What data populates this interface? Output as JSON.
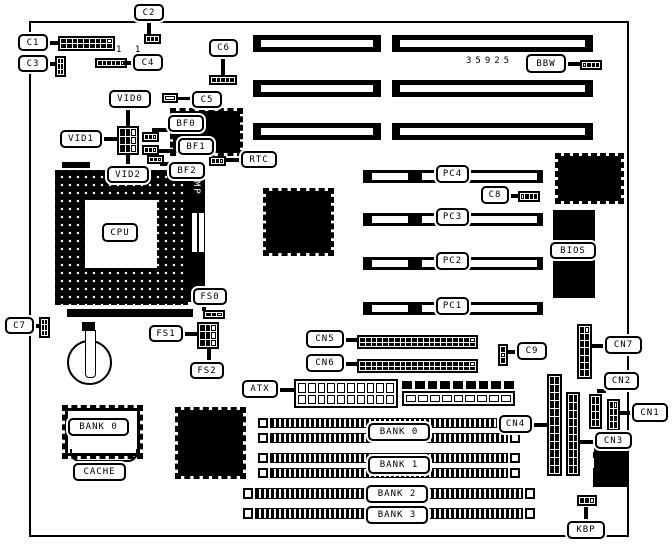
{
  "meta": {
    "description": "Motherboard jumper/connector location diagram, black and white line art",
    "bg_color": "#ffffff",
    "fg_color": "#000000",
    "part_number": "35925"
  },
  "board": {
    "x": 29,
    "y": 21,
    "w": 596,
    "h": 512
  },
  "texts": [
    {
      "id": "part-number",
      "text": "35925",
      "x": 466,
      "y": 56
    },
    {
      "id": "pin1-marks",
      "text": "1 1",
      "x": 116,
      "y": 45
    }
  ],
  "callouts": [
    {
      "id": "c1",
      "label": "C1",
      "x": 18,
      "y": 34,
      "w": 30,
      "h": 17
    },
    {
      "id": "c2",
      "label": "C2",
      "x": 134,
      "y": 4,
      "w": 30,
      "h": 17
    },
    {
      "id": "c3",
      "label": "C3",
      "x": 18,
      "y": 55,
      "w": 30,
      "h": 17
    },
    {
      "id": "c4",
      "label": "C4",
      "x": 133,
      "y": 54,
      "w": 30,
      "h": 17
    },
    {
      "id": "c5",
      "label": "C5",
      "x": 192,
      "y": 91,
      "w": 30,
      "h": 17
    },
    {
      "id": "c6",
      "label": "C6",
      "x": 209,
      "y": 39,
      "w": 29,
      "h": 18
    },
    {
      "id": "c7",
      "label": "C7",
      "x": 5,
      "y": 317,
      "w": 29,
      "h": 17
    },
    {
      "id": "c8",
      "label": "C8",
      "x": 481,
      "y": 186,
      "w": 28,
      "h": 18
    },
    {
      "id": "c9",
      "label": "C9",
      "x": 517,
      "y": 342,
      "w": 30,
      "h": 18
    },
    {
      "id": "vid0",
      "label": "VID0",
      "x": 109,
      "y": 90,
      "w": 42,
      "h": 18
    },
    {
      "id": "vid1",
      "label": "VID1",
      "x": 60,
      "y": 130,
      "w": 42,
      "h": 18
    },
    {
      "id": "vid2",
      "label": "VID2",
      "x": 107,
      "y": 166,
      "w": 42,
      "h": 17
    },
    {
      "id": "bf0",
      "label": "BF0",
      "x": 168,
      "y": 115,
      "w": 36,
      "h": 17
    },
    {
      "id": "bf1",
      "label": "BF1",
      "x": 178,
      "y": 138,
      "w": 36,
      "h": 17
    },
    {
      "id": "bf2",
      "label": "BF2",
      "x": 169,
      "y": 162,
      "w": 36,
      "h": 17
    },
    {
      "id": "rtc",
      "label": "RTC",
      "x": 241,
      "y": 151,
      "w": 36,
      "h": 17
    },
    {
      "id": "cpu",
      "label": "CPU",
      "x": 102,
      "y": 223,
      "w": 36,
      "h": 19
    },
    {
      "id": "fs0",
      "label": "FS0",
      "x": 193,
      "y": 288,
      "w": 34,
      "h": 17
    },
    {
      "id": "fs1",
      "label": "FS1",
      "x": 149,
      "y": 325,
      "w": 34,
      "h": 17
    },
    {
      "id": "fs2",
      "label": "FS2",
      "x": 190,
      "y": 362,
      "w": 34,
      "h": 17
    },
    {
      "id": "cache",
      "label": "CACHE",
      "x": 73,
      "y": 463,
      "w": 53,
      "h": 18
    },
    {
      "id": "atx",
      "label": "ATX",
      "x": 242,
      "y": 380,
      "w": 36,
      "h": 18
    },
    {
      "id": "cn5",
      "label": "CN5",
      "x": 306,
      "y": 330,
      "w": 38,
      "h": 18
    },
    {
      "id": "cn6",
      "label": "CN6",
      "x": 306,
      "y": 354,
      "w": 38,
      "h": 18
    },
    {
      "id": "bbw",
      "label": "BBW",
      "x": 526,
      "y": 54,
      "w": 40,
      "h": 19
    },
    {
      "id": "bios",
      "label": "BIOS",
      "x": 550,
      "y": 242,
      "w": 46,
      "h": 17
    },
    {
      "id": "cn7",
      "label": "CN7",
      "x": 605,
      "y": 336,
      "w": 37,
      "h": 18
    },
    {
      "id": "cn2",
      "label": "CN2",
      "x": 604,
      "y": 372,
      "w": 35,
      "h": 18
    },
    {
      "id": "cn1",
      "label": "CN1",
      "x": 632,
      "y": 403,
      "w": 36,
      "h": 19
    },
    {
      "id": "cn3",
      "label": "CN3",
      "x": 595,
      "y": 432,
      "w": 37,
      "h": 17
    },
    {
      "id": "cn4",
      "label": "CN4",
      "x": 499,
      "y": 415,
      "w": 33,
      "h": 18
    },
    {
      "id": "kbp",
      "label": "KBP",
      "x": 567,
      "y": 521,
      "w": 38,
      "h": 18
    },
    {
      "id": "pc4",
      "label": "PC4",
      "x": 436,
      "y": 165,
      "w": 33,
      "h": 18
    },
    {
      "id": "pc3",
      "label": "PC3",
      "x": 436,
      "y": 208,
      "w": 33,
      "h": 18
    },
    {
      "id": "pc2",
      "label": "PC2",
      "x": 436,
      "y": 252,
      "w": 33,
      "h": 18
    },
    {
      "id": "pc1",
      "label": "PC1",
      "x": 436,
      "y": 297,
      "w": 33,
      "h": 18
    },
    {
      "id": "bank0-cache",
      "label": "BANK 0",
      "x": 68,
      "y": 418,
      "w": 61,
      "h": 18
    },
    {
      "id": "bank0",
      "label": "BANK 0",
      "x": 368,
      "y": 423,
      "w": 62,
      "h": 18
    },
    {
      "id": "bank1",
      "label": "BANK 1",
      "x": 368,
      "y": 456,
      "w": 62,
      "h": 18
    },
    {
      "id": "bank2",
      "label": "BANK 2",
      "x": 366,
      "y": 485,
      "w": 62,
      "h": 18
    },
    {
      "id": "bank3",
      "label": "BANK 3",
      "x": 366,
      "y": 506,
      "w": 62,
      "h": 18
    }
  ],
  "stems": [
    {
      "id": "c1-stem",
      "x": 48,
      "y": 41,
      "w": 11,
      "h": 4
    },
    {
      "id": "c2-stem",
      "x": 147,
      "y": 21,
      "w": 4,
      "h": 14
    },
    {
      "id": "c3-stem",
      "x": 48,
      "y": 62,
      "w": 9,
      "h": 4
    },
    {
      "id": "c4-stem",
      "x": 124,
      "y": 61,
      "w": 9,
      "h": 4
    },
    {
      "id": "c5-stem",
      "x": 177,
      "y": 97,
      "w": 15,
      "h": 3
    },
    {
      "id": "c6-stem",
      "x": 221,
      "y": 57,
      "w": 4,
      "h": 19
    },
    {
      "id": "c7-stem",
      "x": 34,
      "y": 324,
      "w": 6,
      "h": 4
    },
    {
      "id": "c8-stem",
      "x": 509,
      "y": 194,
      "w": 11,
      "h": 4
    },
    {
      "id": "c9-stem",
      "x": 507,
      "y": 350,
      "w": 10,
      "h": 4
    },
    {
      "id": "vid0-stem",
      "x": 126,
      "y": 108,
      "w": 4,
      "h": 19
    },
    {
      "id": "vid1-stem",
      "x": 102,
      "y": 137,
      "w": 16,
      "h": 4
    },
    {
      "id": "vid2-stem",
      "x": 126,
      "y": 154,
      "w": 4,
      "h": 13
    },
    {
      "id": "bf0-stem",
      "x": 152,
      "y": 128,
      "w": 17,
      "h": 4
    },
    {
      "id": "bf1-stem",
      "x": 157,
      "y": 149,
      "w": 22,
      "h": 4
    },
    {
      "id": "bf2-stem",
      "x": 160,
      "y": 162,
      "w": 11,
      "h": 4
    },
    {
      "id": "rtc-stem",
      "x": 225,
      "y": 158,
      "w": 17,
      "h": 4
    },
    {
      "id": "fs0-stem",
      "x": 202,
      "y": 304,
      "w": 4,
      "h": 7
    },
    {
      "id": "fs1-stem",
      "x": 183,
      "y": 332,
      "w": 15,
      "h": 4
    },
    {
      "id": "fs2-stem",
      "x": 207,
      "y": 349,
      "w": 4,
      "h": 14
    },
    {
      "id": "atx-stem",
      "x": 277,
      "y": 388,
      "w": 18,
      "h": 4
    },
    {
      "id": "cn5-stem",
      "x": 343,
      "y": 338,
      "w": 15,
      "h": 4
    },
    {
      "id": "cn6-stem",
      "x": 343,
      "y": 362,
      "w": 15,
      "h": 4
    },
    {
      "id": "bbw-stem",
      "x": 565,
      "y": 62,
      "w": 16,
      "h": 4
    },
    {
      "id": "cn7-stem",
      "x": 591,
      "y": 344,
      "w": 15,
      "h": 4
    },
    {
      "id": "cn2-stem",
      "x": 597,
      "y": 389,
      "w": 9,
      "h": 4
    },
    {
      "id": "cn1-stem",
      "x": 619,
      "y": 411,
      "w": 14,
      "h": 4
    },
    {
      "id": "cn3-stem",
      "x": 580,
      "y": 440,
      "w": 16,
      "h": 4
    },
    {
      "id": "cn4-stem",
      "x": 531,
      "y": 423,
      "w": 17,
      "h": 4
    },
    {
      "id": "kbp-stem",
      "x": 584,
      "y": 507,
      "w": 4,
      "h": 15
    }
  ],
  "isa_slots": [
    {
      "id": "isa-a1",
      "x": 253,
      "y": 35,
      "w": 128,
      "h": 17
    },
    {
      "id": "isa-a2",
      "x": 253,
      "y": 80,
      "w": 128,
      "h": 17
    },
    {
      "id": "isa-a3",
      "x": 253,
      "y": 123,
      "w": 128,
      "h": 17
    },
    {
      "id": "isa-b1",
      "x": 392,
      "y": 35,
      "w": 201,
      "h": 17
    },
    {
      "id": "isa-b2",
      "x": 392,
      "y": 80,
      "w": 201,
      "h": 17
    },
    {
      "id": "isa-b3",
      "x": 392,
      "y": 123,
      "w": 201,
      "h": 17
    }
  ],
  "pci_slots": [
    {
      "id": "pci-4",
      "x": 363,
      "y": 170,
      "w": 180,
      "h": 13
    },
    {
      "id": "pci-3",
      "x": 363,
      "y": 213,
      "w": 180,
      "h": 13
    },
    {
      "id": "pci-2",
      "x": 363,
      "y": 257,
      "w": 180,
      "h": 13
    },
    {
      "id": "pci-1",
      "x": 363,
      "y": 302,
      "w": 180,
      "h": 13
    }
  ],
  "simm_slots": [
    {
      "id": "simm-1",
      "x": 258,
      "y": 418,
      "w": 262,
      "h": 10
    },
    {
      "id": "simm-2",
      "x": 258,
      "y": 433,
      "w": 262,
      "h": 10
    },
    {
      "id": "simm-3",
      "x": 258,
      "y": 453,
      "w": 262,
      "h": 10
    },
    {
      "id": "simm-4",
      "x": 258,
      "y": 468,
      "w": 262,
      "h": 10
    },
    {
      "id": "simm-5",
      "x": 243,
      "y": 488,
      "w": 292,
      "h": 11
    },
    {
      "id": "simm-6",
      "x": 243,
      "y": 508,
      "w": 292,
      "h": 11
    }
  ],
  "chips": [
    {
      "id": "chip-clockgen",
      "x": 170,
      "y": 108,
      "w": 67,
      "h": 42
    },
    {
      "id": "chip-chipset-north",
      "x": 263,
      "y": 188,
      "w": 65,
      "h": 62
    },
    {
      "id": "chip-chipset-south",
      "x": 555,
      "y": 153,
      "w": 63,
      "h": 45
    },
    {
      "id": "chip-io",
      "x": 175,
      "y": 407,
      "w": 65,
      "h": 66
    }
  ],
  "black_rects": [
    {
      "id": "bios-chip",
      "x": 553,
      "y": 210,
      "w": 42,
      "h": 88
    },
    {
      "id": "keyboard-connector",
      "x": 593,
      "y": 438,
      "w": 34,
      "h": 49
    },
    {
      "id": "socket-tab-top",
      "x": 62,
      "y": 162,
      "w": 28,
      "h": 6
    },
    {
      "id": "socket-lever",
      "x": 67,
      "y": 309,
      "w": 126,
      "h": 8
    },
    {
      "id": "battery-clip-top",
      "x": 82,
      "y": 322,
      "w": 13,
      "h": 9
    }
  ],
  "white_rects": [
    {
      "id": "kbd-notch-1",
      "x": 586,
      "y": 443,
      "w": 8,
      "h": 9
    },
    {
      "id": "kbd-notch-2",
      "x": 586,
      "y": 458,
      "w": 8,
      "h": 10
    },
    {
      "id": "mp-dip-1",
      "x": 192,
      "y": 213,
      "w": 5,
      "h": 39
    },
    {
      "id": "mp-dip-2",
      "x": 199,
      "y": 213,
      "w": 5,
      "h": 39
    }
  ],
  "headers": [
    {
      "id": "c1-header",
      "x": 58,
      "y": 36,
      "w": 57,
      "h": 15,
      "cols": 9,
      "rows": 2,
      "white": [
        8
      ]
    },
    {
      "id": "c4-header",
      "x": 95,
      "y": 58,
      "w": 32,
      "h": 10,
      "cols": 6,
      "rows": 1,
      "white": [
        5
      ]
    },
    {
      "id": "c2-conn",
      "x": 144,
      "y": 34,
      "w": 17,
      "h": 10,
      "cols": 3,
      "rows": 1,
      "white": []
    },
    {
      "id": "c6-conn",
      "x": 209,
      "y": 75,
      "w": 28,
      "h": 10,
      "cols": 5,
      "rows": 1,
      "white": []
    },
    {
      "id": "c3-conn",
      "x": 55,
      "y": 56,
      "w": 11,
      "h": 21,
      "cols": 2,
      "rows": 3,
      "white": [
        2
      ]
    },
    {
      "id": "c7-conn",
      "x": 39,
      "y": 317,
      "w": 11,
      "h": 21,
      "cols": 2,
      "rows": 3,
      "white": [
        2
      ]
    },
    {
      "id": "bf0-conn",
      "x": 142,
      "y": 132,
      "w": 17,
      "h": 10,
      "cols": 3,
      "rows": 1,
      "white": [
        2
      ]
    },
    {
      "id": "bf1-conn",
      "x": 142,
      "y": 145,
      "w": 17,
      "h": 10,
      "cols": 3,
      "rows": 1,
      "white": [
        2
      ]
    },
    {
      "id": "bf2-conn",
      "x": 147,
      "y": 155,
      "w": 17,
      "h": 9,
      "cols": 3,
      "rows": 1,
      "white": [
        2
      ]
    },
    {
      "id": "rtc-conn",
      "x": 209,
      "y": 156,
      "w": 17,
      "h": 10,
      "cols": 3,
      "rows": 1,
      "white": [
        2
      ]
    },
    {
      "id": "vid-jumper-block",
      "x": 117,
      "y": 126,
      "w": 22,
      "h": 29,
      "cols": 3,
      "rows": 3,
      "white": [
        2,
        5,
        8
      ]
    },
    {
      "id": "fs0-conn",
      "x": 203,
      "y": 310,
      "w": 22,
      "h": 9,
      "cols": 3,
      "rows": 1,
      "white": [
        2
      ]
    },
    {
      "id": "fs1-jumper-block",
      "x": 197,
      "y": 322,
      "w": 22,
      "h": 27,
      "cols": 3,
      "rows": 3,
      "white": [
        2,
        5,
        8
      ]
    },
    {
      "id": "bbw-conn",
      "x": 580,
      "y": 60,
      "w": 22,
      "h": 10,
      "cols": 4,
      "rows": 1,
      "white": [
        0
      ]
    },
    {
      "id": "c8-conn",
      "x": 518,
      "y": 191,
      "w": 22,
      "h": 11,
      "cols": 4,
      "rows": 1,
      "white": [
        0
      ]
    },
    {
      "id": "c9-conn",
      "x": 498,
      "y": 344,
      "w": 10,
      "h": 22,
      "cols": 1,
      "rows": 3,
      "white": [
        1
      ]
    },
    {
      "id": "cn5-header",
      "x": 357,
      "y": 335,
      "w": 121,
      "h": 14,
      "cols": 20,
      "rows": 2,
      "white": [
        19
      ]
    },
    {
      "id": "cn6-header",
      "x": 357,
      "y": 359,
      "w": 121,
      "h": 14,
      "cols": 20,
      "rows": 2,
      "white": [
        19
      ]
    },
    {
      "id": "cn7-header",
      "x": 577,
      "y": 324,
      "w": 15,
      "h": 55,
      "cols": 2,
      "rows": 7,
      "white": [
        1
      ]
    },
    {
      "id": "cn2-header",
      "x": 589,
      "y": 394,
      "w": 13,
      "h": 35,
      "cols": 2,
      "rows": 4,
      "white": []
    },
    {
      "id": "cn1-header",
      "x": 607,
      "y": 399,
      "w": 13,
      "h": 32,
      "cols": 2,
      "rows": 4,
      "white": [
        1
      ]
    },
    {
      "id": "cn3-header",
      "x": 566,
      "y": 392,
      "w": 14,
      "h": 84,
      "cols": 2,
      "rows": 10,
      "white": []
    },
    {
      "id": "cn4-header",
      "x": 547,
      "y": 374,
      "w": 15,
      "h": 102,
      "cols": 2,
      "rows": 12,
      "white": []
    },
    {
      "id": "kbp-conn",
      "x": 577,
      "y": 495,
      "w": 20,
      "h": 11,
      "cols": 3,
      "rows": 1,
      "white": [
        2
      ]
    },
    {
      "id": "c5-rect",
      "x": 162,
      "y": 93,
      "w": 16,
      "h": 10,
      "cols": 1,
      "rows": 1,
      "white": [
        0
      ]
    },
    {
      "id": "atx-power-conn",
      "x": 294,
      "y": 379,
      "w": 104,
      "h": 29,
      "cols": 10,
      "rows": 2,
      "white": [],
      "style": "outline"
    },
    {
      "id": "at-power-pins",
      "x": 402,
      "y": 381,
      "w": 112,
      "h": 8,
      "cols": 9,
      "rows": 1,
      "white": [],
      "style": "bare"
    },
    {
      "id": "at-power-body",
      "x": 402,
      "y": 391,
      "w": 113,
      "h": 15,
      "cols": 9,
      "rows": 1,
      "white": [],
      "style": "outline"
    }
  ],
  "cpu": {
    "socket": {
      "x": 55,
      "y": 170,
      "w": 133,
      "h": 135
    },
    "center": {
      "x": 85,
      "y": 200,
      "w": 72,
      "h": 68
    },
    "mp_strip": {
      "x": 187,
      "y": 173,
      "w": 18,
      "h": 129,
      "label": "MP"
    }
  },
  "cache_chip": {
    "x": 62,
    "y": 405,
    "w": 75,
    "h": 48
  },
  "battery": {
    "x": 67,
    "y": 340,
    "w": 45,
    "h": 45,
    "clip": {
      "x": 85,
      "y": 330,
      "w": 9,
      "h": 46
    }
  },
  "brace": {
    "x": 70,
    "y": 449,
    "w": 64,
    "h": 11
  }
}
